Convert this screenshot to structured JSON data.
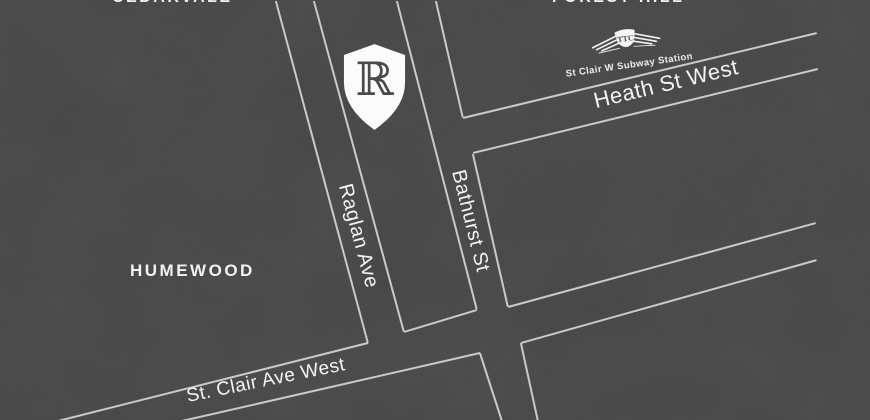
{
  "map": {
    "colors": {
      "background": "#4b4b4b",
      "road_line": "#e0e0e0",
      "label_text": "#f4f4f4",
      "marker_fill": "#fbfbfb",
      "marker_letter": "#4a4a4a"
    },
    "neighborhoods": {
      "cedarvale": "CEDARVALE",
      "forest_hill": "FOREST HILL",
      "humewood": "HUMEWOOD"
    },
    "streets": {
      "raglan": "Raglan Ave",
      "bathurst": "Bathurst St",
      "heath": "Heath St West",
      "st_clair": "St. Clair Ave West"
    },
    "station": {
      "label": "St Clair W Subway Station",
      "ttc_monogram": "TTC"
    },
    "marker": {
      "glyph": "ℝ"
    },
    "roads": [
      {
        "name": "raglan-ave-west-line",
        "x1": 276,
        "y1": 0,
        "x2": 368,
        "y2": 342
      },
      {
        "name": "raglan-ave-east-line",
        "x1": 314,
        "y1": 0,
        "x2": 404,
        "y2": 331
      },
      {
        "name": "bathurst-st-west-line",
        "x1": 397,
        "y1": 0,
        "x2": 477,
        "y2": 309
      },
      {
        "name": "bathurst-st-east-line-north",
        "x1": 436,
        "y1": 0,
        "x2": 463,
        "y2": 117
      },
      {
        "name": "bathurst-st-east-line-mid",
        "x1": 473,
        "y1": 153,
        "x2": 508,
        "y2": 306
      },
      {
        "name": "bathurst-st-west-line-south",
        "x1": 480,
        "y1": 352,
        "x2": 502,
        "y2": 420
      },
      {
        "name": "bathurst-st-east-line-south",
        "x1": 521,
        "y1": 342,
        "x2": 538,
        "y2": 420
      },
      {
        "name": "heath-st-north-line",
        "x1": 463,
        "y1": 117,
        "x2": 817,
        "y2": 32
      },
      {
        "name": "heath-st-south-line",
        "x1": 473,
        "y1": 152,
        "x2": 818,
        "y2": 68
      },
      {
        "name": "st-clair-north-line-west",
        "x1": 58,
        "y1": 420,
        "x2": 368,
        "y2": 342
      },
      {
        "name": "st-clair-north-line-mid",
        "x1": 404,
        "y1": 331,
        "x2": 477,
        "y2": 309
      },
      {
        "name": "st-clair-north-line-east",
        "x1": 508,
        "y1": 306,
        "x2": 816,
        "y2": 222
      },
      {
        "name": "st-clair-south-line-west",
        "x1": 182,
        "y1": 420,
        "x2": 480,
        "y2": 352
      },
      {
        "name": "st-clair-south-line-east",
        "x1": 521,
        "y1": 342,
        "x2": 817,
        "y2": 259
      }
    ]
  }
}
